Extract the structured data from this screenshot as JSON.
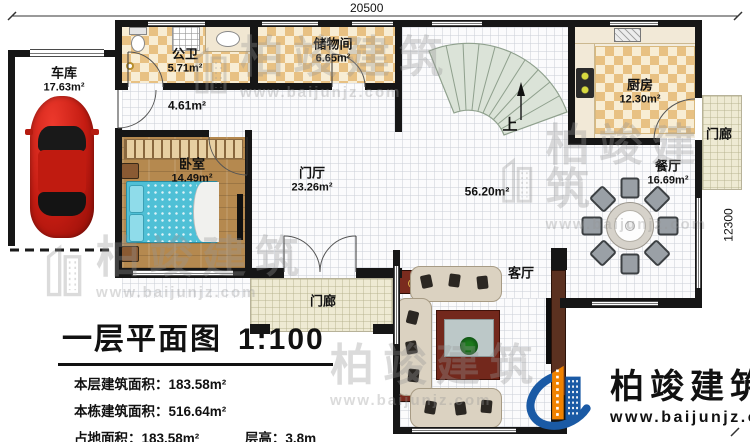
{
  "dimensions": {
    "top": "20500",
    "right": "12300"
  },
  "rooms": [
    {
      "id": "garage",
      "name": "车库",
      "area": "17.63m²"
    },
    {
      "id": "bathroom",
      "name": "公卫",
      "area": "5.71m²"
    },
    {
      "id": "storage",
      "name": "储物间",
      "area": "6.65m²"
    },
    {
      "id": "hallway",
      "area": "4.61m²"
    },
    {
      "id": "bedroom",
      "name": "卧室",
      "area": "14.49m²"
    },
    {
      "id": "foyer",
      "name": "门厅",
      "area": "23.26m²"
    },
    {
      "id": "kitchen",
      "name": "厨房",
      "area": "12.30m²"
    },
    {
      "id": "dining",
      "name": "餐厅",
      "area": "16.69m²"
    },
    {
      "id": "living",
      "name": "客厅"
    },
    {
      "id": "open-area",
      "area": "56.20m²"
    },
    {
      "id": "porch-right",
      "name": "门廊"
    },
    {
      "id": "porch-front",
      "name": "门廊"
    },
    {
      "id": "stairs",
      "name": "上"
    }
  ],
  "title_block": {
    "title": "一层平面图",
    "scale": "1:100",
    "stats": [
      {
        "label": "本层建筑面积：",
        "value": "183.58m²"
      },
      {
        "label": "本栋建筑面积：",
        "value": "516.64m²"
      },
      {
        "label": "占地面积：",
        "value": "183.58m²"
      },
      {
        "label": "层高：",
        "value": "3.8m"
      }
    ]
  },
  "branding": {
    "company": "柏竣建筑",
    "website": "www.baijunjz.com"
  },
  "watermark": {
    "text": "柏竣建筑",
    "url": "www.baijunjz.com"
  }
}
